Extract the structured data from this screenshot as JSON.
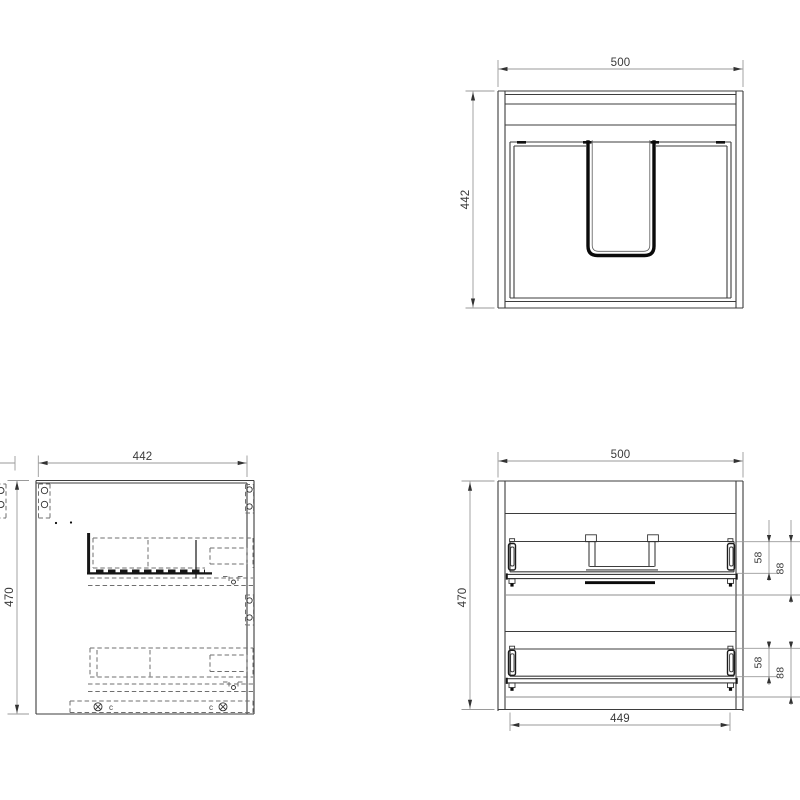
{
  "views": {
    "top": {
      "dim_width": "500",
      "dim_height": "442"
    },
    "side": {
      "dim_width": "442",
      "dim_height": "470",
      "marker_left": "c",
      "marker_right": "c"
    },
    "front": {
      "dim_width": "500",
      "dim_height": "470",
      "dim_bottom_width": "449",
      "upper_drawer": {
        "dim_side": "58",
        "dim_total": "88"
      },
      "lower_drawer": {
        "dim_side": "58",
        "dim_total": "88"
      }
    }
  },
  "colors": {
    "line": "#3d3d3d",
    "heavy_line": "#0a0a0a",
    "hidden_line": "#6f6f6f",
    "dimension_line": "#9a9a9a",
    "text": "#3a3a3a"
  }
}
